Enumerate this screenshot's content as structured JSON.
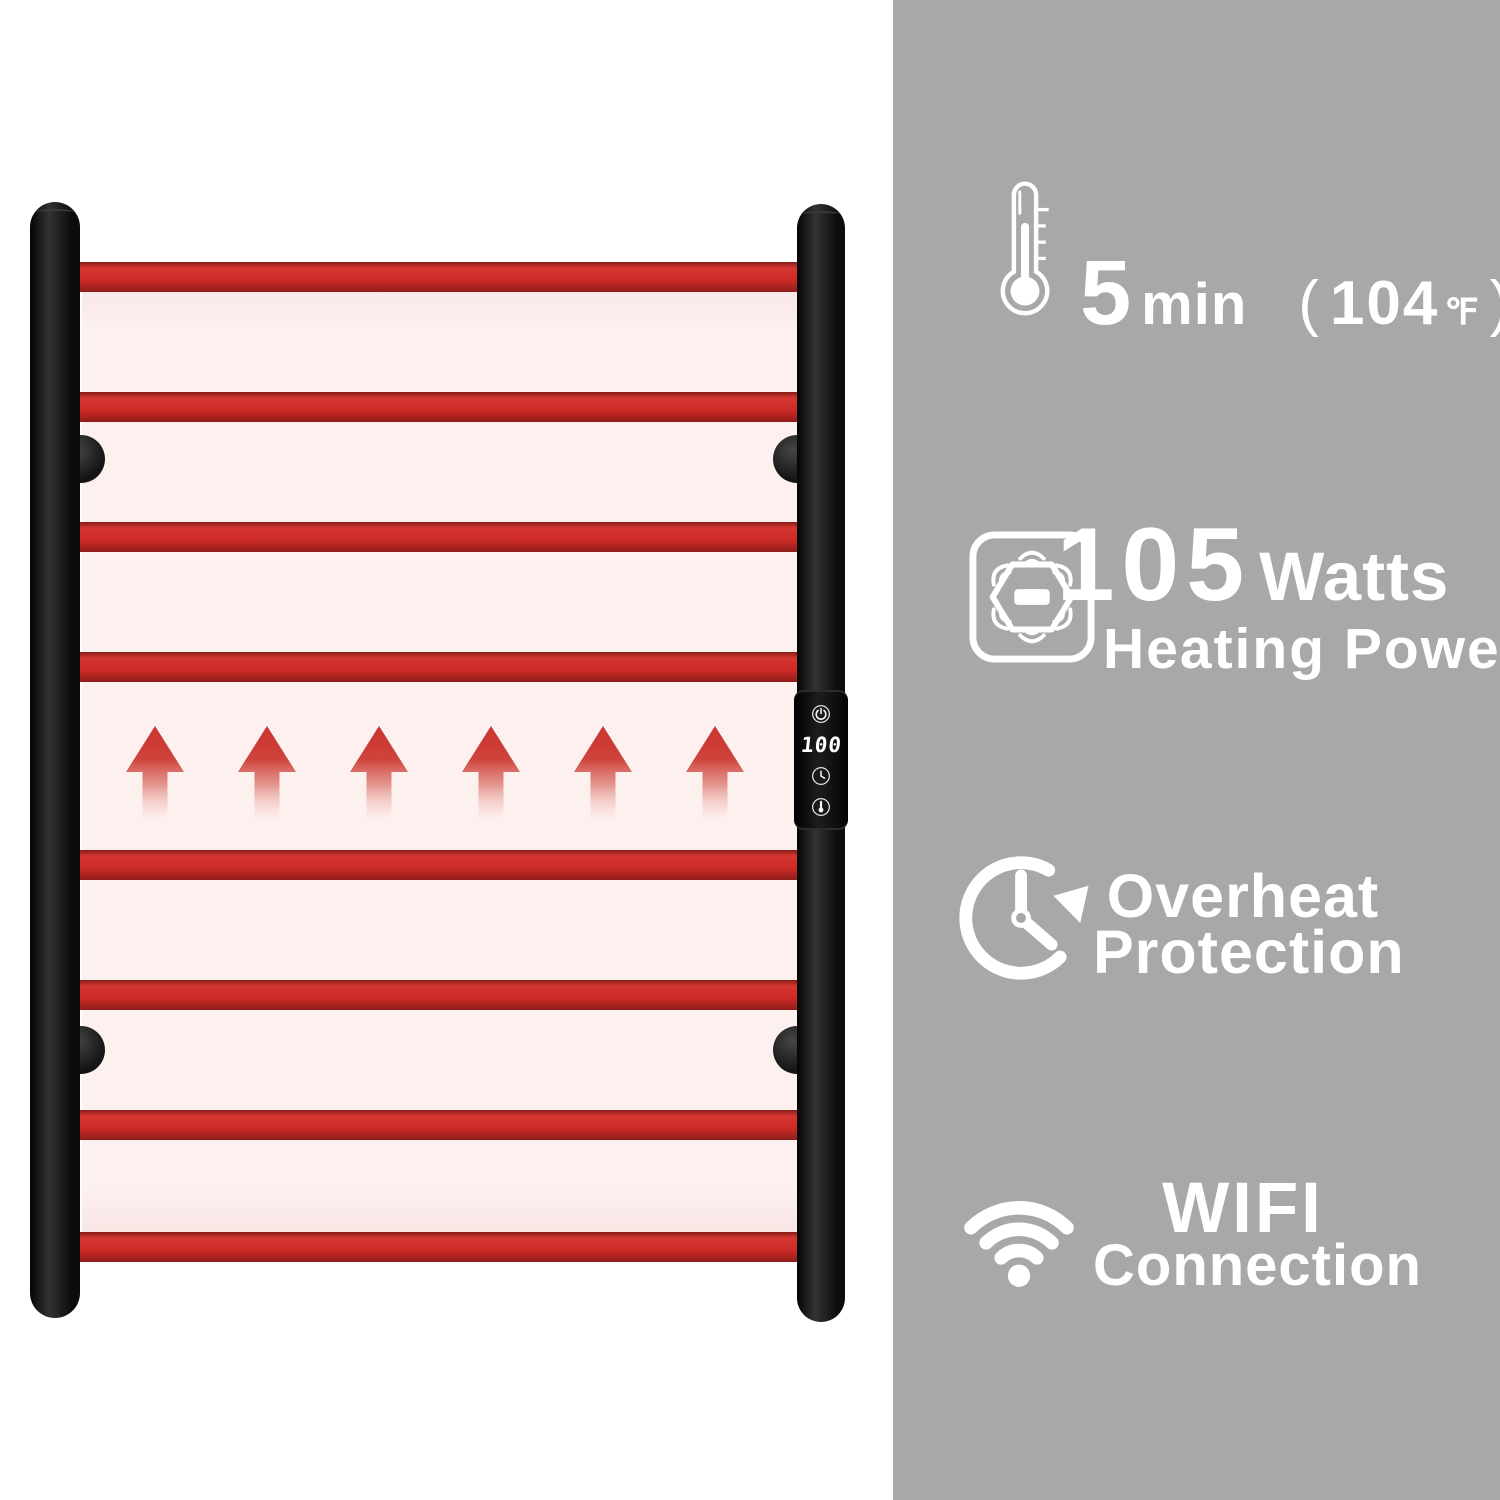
{
  "meta": {
    "description": "heated towel rail product feature infographic"
  },
  "colors": {
    "background": "#ffffff",
    "feature_panel_gray": "#a8a8a8",
    "bar_red": "#cc2a27",
    "panel_pink": "#fdf1f0",
    "rail_black": "#141414",
    "feature_text": "#ffffff",
    "display_text": "#ffffff"
  },
  "device": {
    "name": "heated-towel-rail",
    "bars_count": 8,
    "heat_arrows_count": 6,
    "control_panel": {
      "display_value": "100",
      "buttons": [
        {
          "icon": "power-icon"
        },
        {
          "icon": "timer-icon"
        },
        {
          "icon": "temperature-icon"
        }
      ]
    }
  },
  "features": [
    {
      "icon": "thermometer-icon",
      "value": "5",
      "unit": "min",
      "note_open": "(",
      "note_value": "104",
      "note_unit": "℉",
      "note_close": ")"
    },
    {
      "icon": "heating-power-icon",
      "value": "105",
      "unit": "Watts",
      "label": "Heating Power"
    },
    {
      "icon": "overheat-protection-icon",
      "line1": "Overheat",
      "line2": "Protection"
    },
    {
      "icon": "wifi-icon",
      "line1": "WIFI",
      "line2": "Connection"
    }
  ]
}
